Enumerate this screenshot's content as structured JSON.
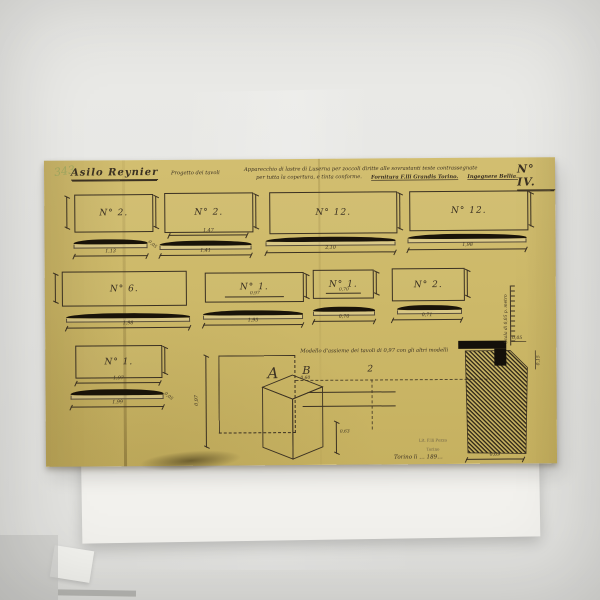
{
  "colors": {
    "paper": "#cdb969",
    "ink": "#3b3122",
    "plank_black": "#191309",
    "background": "#e7e7e4",
    "white_sheet": "#f2f1ed",
    "archive_green": "#94a35d"
  },
  "header": {
    "archive_mark": "343",
    "title": "Asilo Reynier",
    "subtitle": "Progetto dei tavoli",
    "description_line1": "Apparecchio di lastre di Luserna per zoccoli diritte alle sovrastanti teste contrassegnate",
    "description_line2": "per tutta la copertura, e tinta conforme.",
    "supplier": "Fornitura F.lli Grandis Torino.",
    "engineer": "Ingegnere Bellia.",
    "plate_number": "N° IV."
  },
  "panels": [
    {
      "label": "N° 2.",
      "width_dim": "1,13",
      "thickness_dim": "0,05"
    },
    {
      "label": "N° 2.",
      "rect_dim": "1,47",
      "width_dim": "1,41"
    },
    {
      "label": "N° 12.",
      "width_dim": "2,10"
    },
    {
      "label": "N° 12.",
      "width_dim": "1,98"
    },
    {
      "label": "N° 6.",
      "width_dim": "1,98"
    },
    {
      "label": "N° 1.",
      "inner_dim": "0,97",
      "width_dim": "1,95"
    },
    {
      "label": "N° 1.",
      "inner_dim": "0,70",
      "width_dim": "0,70"
    },
    {
      "label": "N° 2.",
      "width_dim": "0,71"
    },
    {
      "label": "N° 1.",
      "rect_dim": "1,97",
      "width_dim": "1,99",
      "thickness_dim": "0,05"
    }
  ],
  "assembly": {
    "caption": "Modello d'assieme dei tavoli di 0,97 con gli altri modelli",
    "label_a": "A",
    "label_b": "B",
    "dim_b": "0,60",
    "dim_left": "0,97",
    "center_mark": "2",
    "dim_height": "0,63"
  },
  "scale_ruler": {
    "label": "Scala di 0,05 p. metro"
  },
  "section": {
    "dim_top": "0,05",
    "dim_side": "0,15",
    "dim_bottom": "0,09"
  },
  "stamp": {
    "line1": "Lit. F.lli Pozzo",
    "line2": "Torino",
    "date": "Torino li … 189…"
  }
}
